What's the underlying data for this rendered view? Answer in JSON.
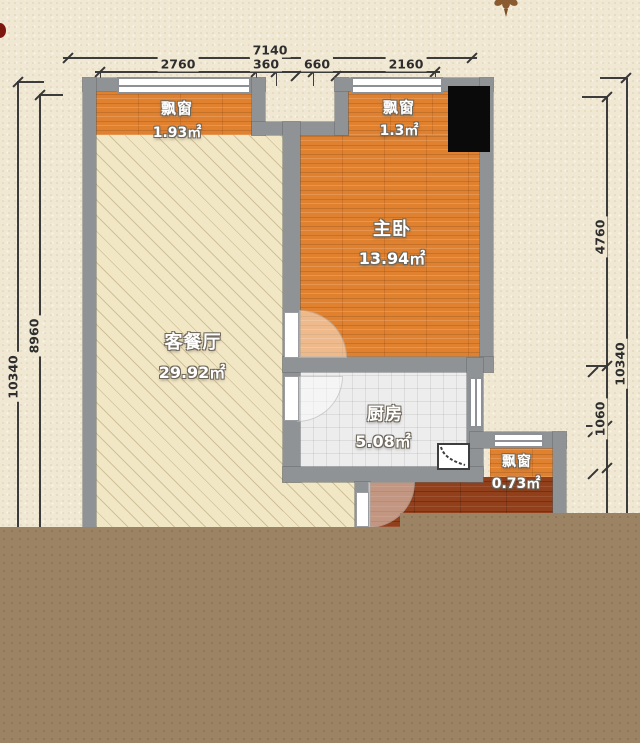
{
  "plan": {
    "title": "apartment-floor-plan",
    "rooms": [
      {
        "id": "living-dining",
        "name": "客餐厅",
        "area": "29.92㎡"
      },
      {
        "id": "master-bedroom",
        "name": "主卧",
        "area": "13.94㎡"
      },
      {
        "id": "kitchen",
        "name": "厨房",
        "area": "5.08㎡"
      }
    ],
    "bay_windows": [
      {
        "id": "bay-left",
        "name": "飘窗",
        "area": "1.93㎡"
      },
      {
        "id": "bay-top-right",
        "name": "飘窗",
        "area": "1.3㎡"
      },
      {
        "id": "bay-lower-right",
        "name": "飘窗",
        "area": "0.73㎡"
      }
    ],
    "dimensions": {
      "top": {
        "total": "7140",
        "segments": [
          "2760",
          "360",
          "660",
          "2160"
        ]
      },
      "left": {
        "outer": "10340",
        "inner": "8960"
      },
      "right": {
        "outer": "10340",
        "segments": [
          "4760",
          "1060"
        ]
      }
    },
    "icons": {
      "gas_meter": "gas-meter-icon",
      "ornament": "fleur-ornament-icon",
      "stain": "red-stain-mark"
    },
    "colors": {
      "background": "#f0e8d3",
      "wall": "#8f9396",
      "wood_floor": "#e0812f",
      "dark_wood_floor": "#92401b",
      "living_tile": "#f2e7c5",
      "kitchen_tile": "#ededee",
      "column_block": "#0a0a0a",
      "bottom_overlay": "#9b8364",
      "dimension_line": "#3c3c3c"
    }
  }
}
